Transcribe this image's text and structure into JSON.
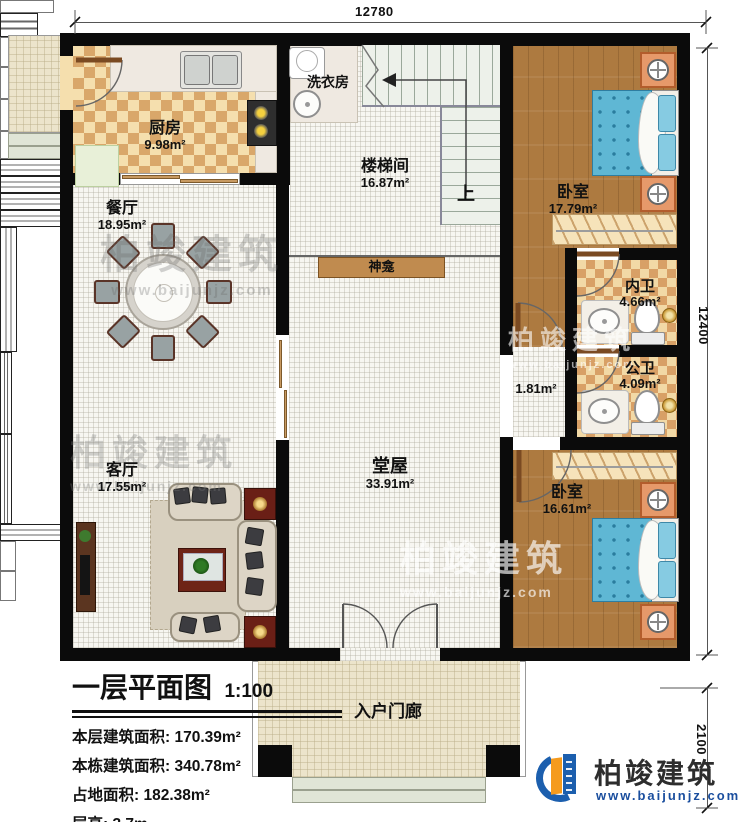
{
  "dimensions": {
    "top": "12780",
    "right": "12400",
    "porch": "2100"
  },
  "rooms": {
    "kitchen": {
      "name": "厨房",
      "area": "9.98m²"
    },
    "laundry": {
      "name": "洗衣房"
    },
    "stairwell": {
      "name": "楼梯间",
      "area": "16.87m²"
    },
    "stairs_up": "上",
    "dining": {
      "name": "餐厅",
      "area": "18.95m²"
    },
    "bedroom_top": {
      "name": "卧室",
      "area": "17.79m²"
    },
    "inner_bath": {
      "name": "内卫",
      "area": "4.66m²"
    },
    "public_bath": {
      "name": "公卫",
      "area": "4.09m²"
    },
    "corridor": {
      "area": "1.81m²"
    },
    "shrine": {
      "name": "神龛"
    },
    "hall": {
      "name": "堂屋",
      "area": "33.91m²"
    },
    "living": {
      "name": "客厅",
      "area": "17.55m²"
    },
    "bedroom_bottom": {
      "name": "卧室",
      "area": "16.61m²"
    },
    "porch": {
      "name": "入户门廊"
    }
  },
  "title_block": {
    "title": "一层平面图",
    "scale": "1:100",
    "stats": [
      "本层建筑面积: 170.39m²",
      "本栋建筑面积: 340.78m²",
      "占地面积: 182.38m²",
      "层高: 3.7m"
    ]
  },
  "watermark": {
    "brand": "柏竣建筑",
    "site": "www.baijunjz.com"
  },
  "logo": {
    "brand": "柏竣建筑",
    "site": "www.baijunjz.com"
  },
  "colors": {
    "accent_blue": "#1c5fae",
    "accent_orange": "#f59b1e",
    "wall": "#0b0b0b"
  }
}
